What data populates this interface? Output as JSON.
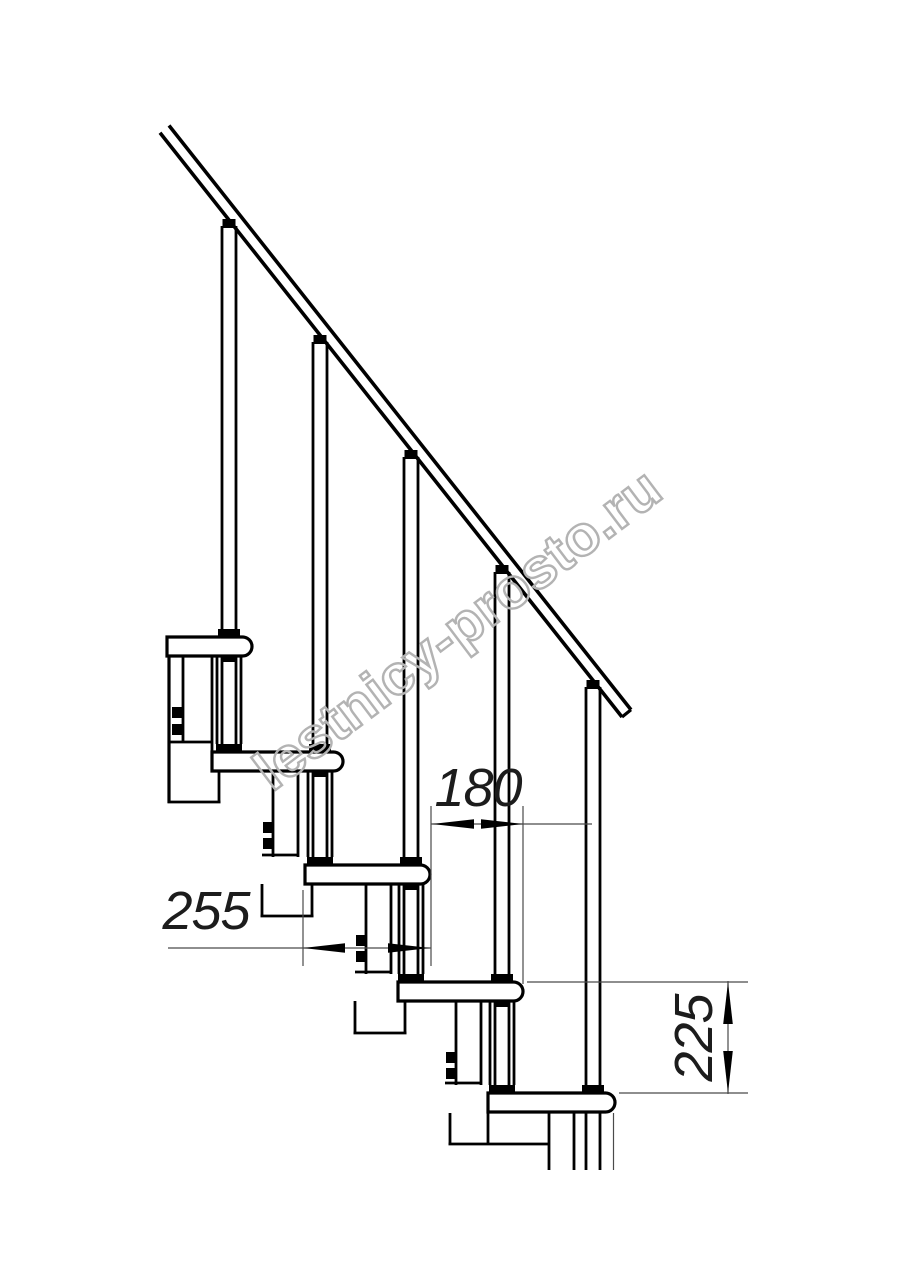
{
  "figure": {
    "kind": "technical-line-drawing",
    "subject": "staircase side elevation with handrail, balusters and modular supports",
    "background": "#ffffff",
    "line_color": "#000000",
    "treads_count": 5,
    "balusters_count": 5,
    "dimensions": [
      {
        "id": "dim-180",
        "value": "180",
        "orientation": "horizontal"
      },
      {
        "id": "dim-255",
        "value": "255",
        "orientation": "horizontal"
      },
      {
        "id": "dim-225",
        "value": "225",
        "orientation": "vertical"
      }
    ],
    "watermark": {
      "text": "lestnicy-prosto.ru",
      "color": "#b3b3b3"
    }
  }
}
